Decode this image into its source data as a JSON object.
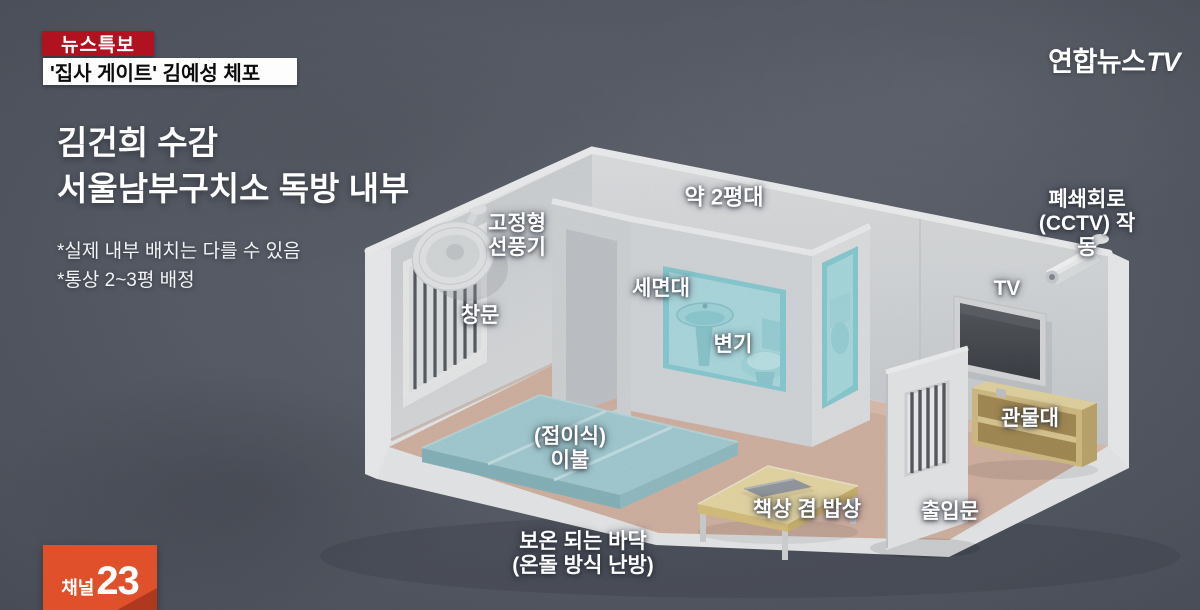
{
  "header": {
    "breaking_badge": "뉴스특보",
    "headline": "'집사 게이트' 김예성 체포"
  },
  "logo": {
    "text": "연합뉴스",
    "suffix": "TV"
  },
  "title": {
    "line1": "김건희 수감",
    "line2": "서울남부구치소 독방 내부"
  },
  "notes": [
    "*실제 내부 배치는 다를 수 있음",
    "*통상 2~3평 배정"
  ],
  "diagram": {
    "labels": {
      "area": "약 2평대",
      "fan": "고정형\n선풍기",
      "window": "창문",
      "sink": "세면대",
      "toilet": "변기",
      "cctv": "폐쇄회로\n(CCTV) 작동",
      "tv": "TV",
      "shelf": "관물대",
      "bedding": "(접이식)\n이불",
      "desk": "책상 겸 밥상",
      "door": "출입문",
      "floor": "보온 되는 바닥\n(온돌 방식 난방)"
    }
  },
  "channel_badge": {
    "prefix": "채널",
    "number": "23"
  },
  "colors": {
    "background": "#5a5f6a",
    "badge_red": "#b01220",
    "channel_orange": "#e0502b",
    "bathroom_teal": "#a9dde2",
    "floor_pink": "#d8b8a8",
    "wood": "#e8d7a6"
  }
}
